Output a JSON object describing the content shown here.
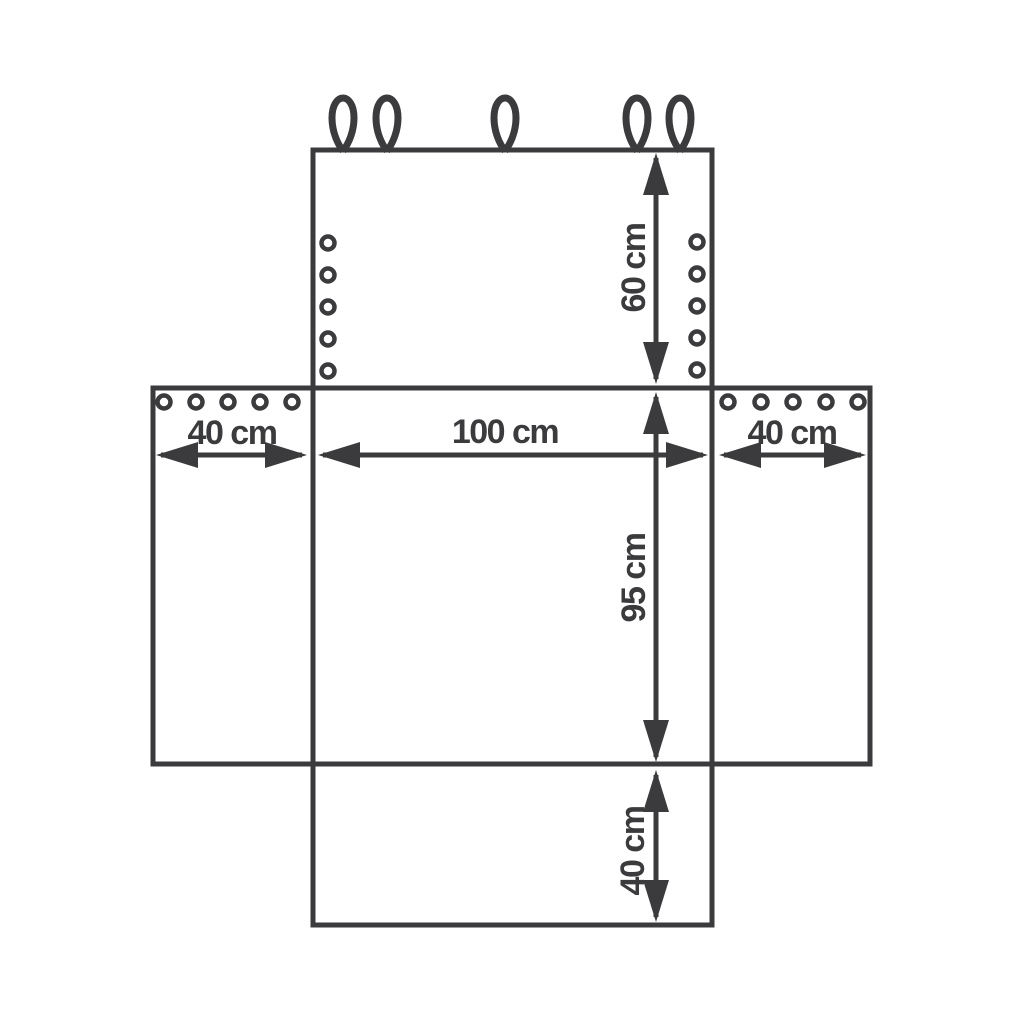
{
  "diagram": {
    "type": "dimension-diagram-unfolded-cover",
    "background_color": "#ffffff",
    "line_color": "#3b3b3d",
    "dimensions": {
      "top_height": "60 cm",
      "left_width": "40 cm",
      "center_width": "100 cm",
      "center_height": "95 cm",
      "right_width": "40 cm",
      "bottom_height": "40 cm"
    },
    "features": {
      "hanging_loops_top_edge": 5,
      "eyelets_top_panel_left_column": 5,
      "eyelets_top_panel_right_column": 5,
      "eyelets_left_flap_top_row": 5,
      "eyelets_right_flap_top_row": 5
    }
  }
}
